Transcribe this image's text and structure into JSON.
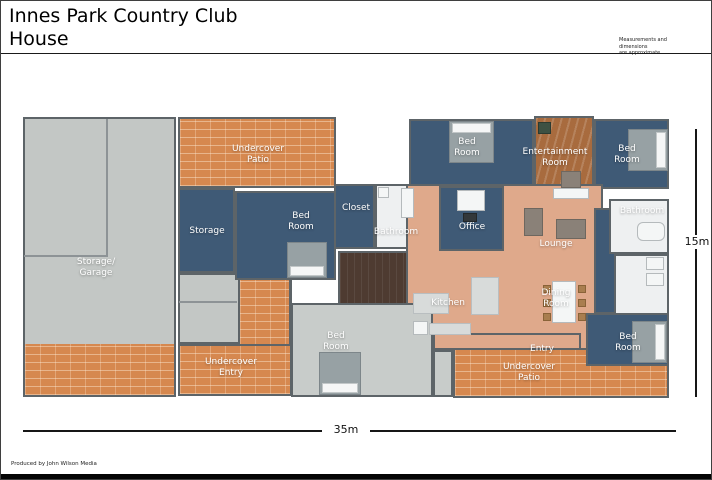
{
  "header": {
    "title": "Innes Park Country Club\nHouse",
    "note": "Measurements and dimensions\nare approximate."
  },
  "rooms": {
    "storage_garage": "Storage/\nGarage",
    "undercover_patio_top": "Undercover\nPatio",
    "storage": "Storage",
    "bedroom_left": "Bed\nRoom",
    "closet": "Closet",
    "bathroom_middle": "Bathroom",
    "bedroom_top_middle": "Bed\nRoom",
    "entertainment_room": "Entertainment\nRoom",
    "bedroom_top_right": "Bed\nRoom",
    "bathroom_right": "Bathroom",
    "office": "Office",
    "lounge": "Lounge",
    "kitchen": "Kitchen",
    "dining_room": "Dining\nRoom",
    "bedroom_bottom_middle": "Bed\nRoom",
    "undercover_entry": "Undercover\nEntry",
    "entry": "Entry",
    "undercover_patio_bottom": "Undercover\nPatio",
    "bedroom_bottom_right": "Bed\nRoom"
  },
  "dimensions": {
    "width_label": "35m",
    "height_label": "15m"
  },
  "footer": {
    "credit": "Produced by John Wilson Media"
  },
  "colors": {
    "room_blue": "#3f5a76",
    "floor_tan": "#dfa98b",
    "patio_brick": "#d6884f",
    "garage_gray": "#c3c7c5",
    "bedroom_gray": "#c8ccca",
    "wood_floor": "#a86b3e",
    "hall_brown": "#4e3b31",
    "wall_gray": "#5d6468"
  }
}
